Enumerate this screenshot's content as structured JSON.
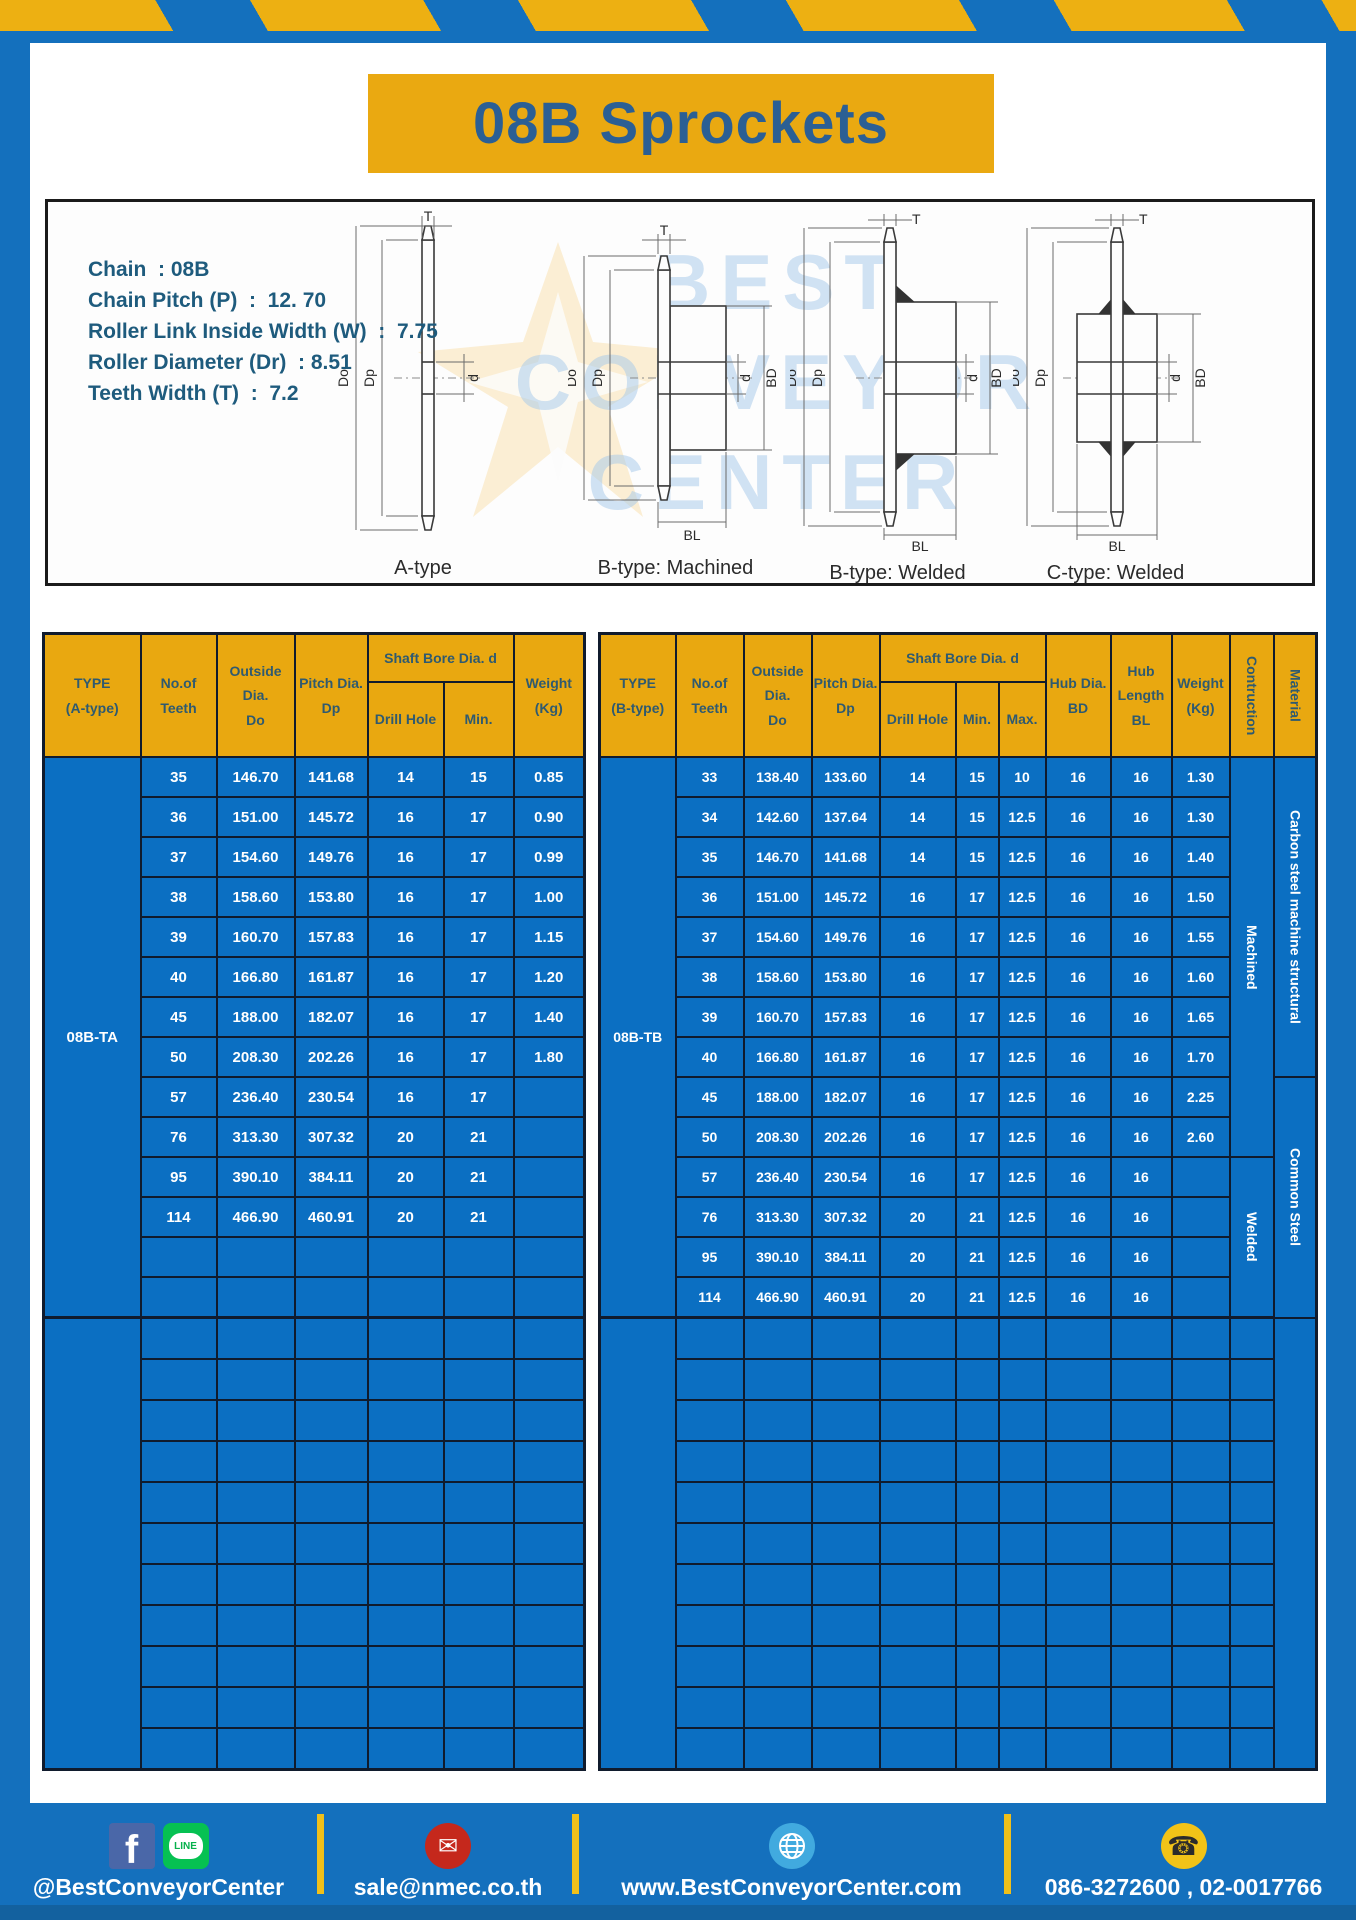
{
  "title": "08B Sprockets",
  "specs": [
    "Chain  : 08B",
    "Chain Pitch (P)  :  12. 70",
    "Roller Link Inside Width (W)  :  7.75",
    "Roller Diameter (Dr)  : 8.51",
    "Teeth Width (T)  :  7.2"
  ],
  "watermark": {
    "line1": "BEST",
    "line2": "CONVEYOR",
    "line3": "CENTER"
  },
  "diagrams": [
    {
      "caption": "A-type",
      "dims": {
        "t": "T",
        "outside": "Do",
        "pitch": "Dp",
        "bore": "d"
      }
    },
    {
      "caption": "B-type: Machined",
      "dims": {
        "t": "T",
        "outside": "Do",
        "pitch": "Dp",
        "bore": "d",
        "hub_dia": "BD",
        "hub_len": "BL"
      }
    },
    {
      "caption": "B-type: Welded",
      "dims": {
        "t": "T",
        "outside": "Do",
        "pitch": "Dp",
        "bore": "d",
        "hub_dia": "BD",
        "hub_len": "BL"
      }
    },
    {
      "caption": "C-type: Welded",
      "dims": {
        "t": "T",
        "outside": "Do",
        "pitch": "Dp",
        "bore": "d",
        "hub_dia": "BD",
        "hub_len": "BL"
      }
    }
  ],
  "table_a": {
    "headers": {
      "type": "TYPE\n(A-type)",
      "teeth": "No.of\nTeeth",
      "outside": "Outside\nDia.\nDo",
      "pitch": "Pitch Dia.\nDp",
      "shaft_bore": "Shaft Bore Dia. d",
      "drill": "Drill Hole",
      "min": "Min.",
      "weight": "Weight\n(Kg)"
    },
    "type_value": "08B-TA",
    "rows": [
      [
        "35",
        "146.70",
        "141.68",
        "14",
        "15",
        "0.85"
      ],
      [
        "36",
        "151.00",
        "145.72",
        "16",
        "17",
        "0.90"
      ],
      [
        "37",
        "154.60",
        "149.76",
        "16",
        "17",
        "0.99"
      ],
      [
        "38",
        "158.60",
        "153.80",
        "16",
        "17",
        "1.00"
      ],
      [
        "39",
        "160.70",
        "157.83",
        "16",
        "17",
        "1.15"
      ],
      [
        "40",
        "166.80",
        "161.87",
        "16",
        "17",
        "1.20"
      ],
      [
        "45",
        "188.00",
        "182.07",
        "16",
        "17",
        "1.40"
      ],
      [
        "50",
        "208.30",
        "202.26",
        "16",
        "17",
        "1.80"
      ],
      [
        "57",
        "236.40",
        "230.54",
        "16",
        "17",
        ""
      ],
      [
        "76",
        "313.30",
        "307.32",
        "20",
        "21",
        ""
      ],
      [
        "95",
        "390.10",
        "384.11",
        "20",
        "21",
        ""
      ],
      [
        "114",
        "466.90",
        "460.91",
        "20",
        "21",
        ""
      ]
    ],
    "empty_upper_rows": 2,
    "lower_rows": 11,
    "data_cols": 6,
    "lower_cols": 6
  },
  "table_b": {
    "headers": {
      "type": "TYPE\n(B-type)",
      "teeth": "No.of\nTeeth",
      "outside": "Outside\nDia.\nDo",
      "pitch": "Pitch Dia.\nDp",
      "shaft_bore": "Shaft Bore Dia. d",
      "drill": "Drill Hole",
      "min": "Min.",
      "max": "Max.",
      "hub_dia": "Hub Dia.\nBD",
      "hub_len": "Hub\nLength\nBL",
      "weight": "Weight\n(Kg)",
      "construction": "Contruction",
      "material": "Material"
    },
    "type_value": "08B-TB",
    "rows": [
      [
        "33",
        "138.40",
        "133.60",
        "14",
        "15",
        "10",
        "16",
        "16",
        "1.30"
      ],
      [
        "34",
        "142.60",
        "137.64",
        "14",
        "15",
        "12.5",
        "16",
        "16",
        "1.30"
      ],
      [
        "35",
        "146.70",
        "141.68",
        "14",
        "15",
        "12.5",
        "16",
        "16",
        "1.40"
      ],
      [
        "36",
        "151.00",
        "145.72",
        "16",
        "17",
        "12.5",
        "16",
        "16",
        "1.50"
      ],
      [
        "37",
        "154.60",
        "149.76",
        "16",
        "17",
        "12.5",
        "16",
        "16",
        "1.55"
      ],
      [
        "38",
        "158.60",
        "153.80",
        "16",
        "17",
        "12.5",
        "16",
        "16",
        "1.60"
      ],
      [
        "39",
        "160.70",
        "157.83",
        "16",
        "17",
        "12.5",
        "16",
        "16",
        "1.65"
      ],
      [
        "40",
        "166.80",
        "161.87",
        "16",
        "17",
        "12.5",
        "16",
        "16",
        "1.70"
      ],
      [
        "45",
        "188.00",
        "182.07",
        "16",
        "17",
        "12.5",
        "16",
        "16",
        "2.25"
      ],
      [
        "50",
        "208.30",
        "202.26",
        "16",
        "17",
        "12.5",
        "16",
        "16",
        "2.60"
      ],
      [
        "57",
        "236.40",
        "230.54",
        "16",
        "17",
        "12.5",
        "16",
        "16",
        ""
      ],
      [
        "76",
        "313.30",
        "307.32",
        "20",
        "21",
        "12.5",
        "16",
        "16",
        ""
      ],
      [
        "95",
        "390.10",
        "384.11",
        "20",
        "21",
        "12.5",
        "16",
        "16",
        ""
      ],
      [
        "114",
        "466.90",
        "460.91",
        "20",
        "21",
        "12.5",
        "16",
        "16",
        ""
      ]
    ],
    "construction_spans": [
      {
        "label": "Machined",
        "rows": 10
      },
      {
        "label": "Welded",
        "rows": 4
      }
    ],
    "material_spans": [
      {
        "label": "Carbon steel  machine structural",
        "rows": 8
      },
      {
        "label": "Common  Steel",
        "rows": 6
      }
    ],
    "empty_upper_rows": 0,
    "lower_rows": 11,
    "data_cols": 9,
    "lower_cols": 10
  },
  "footer": {
    "social_handle": "@BestConveyorCenter",
    "line_label": "LINE",
    "fb_label": "f",
    "email": "sale@nmec.co.th",
    "email_glyph": "✉",
    "website": "www.BestConveyorCenter.com",
    "phone": "086-3272600 , 02-0017766",
    "phone_glyph": "☎"
  },
  "colors": {
    "bar_blue": "#1470bd",
    "stripe_yellow": "#edb012",
    "table_blue": "#0b6fc2",
    "header_yellow": "#e9a810",
    "title_blue": "#2b5f94"
  }
}
